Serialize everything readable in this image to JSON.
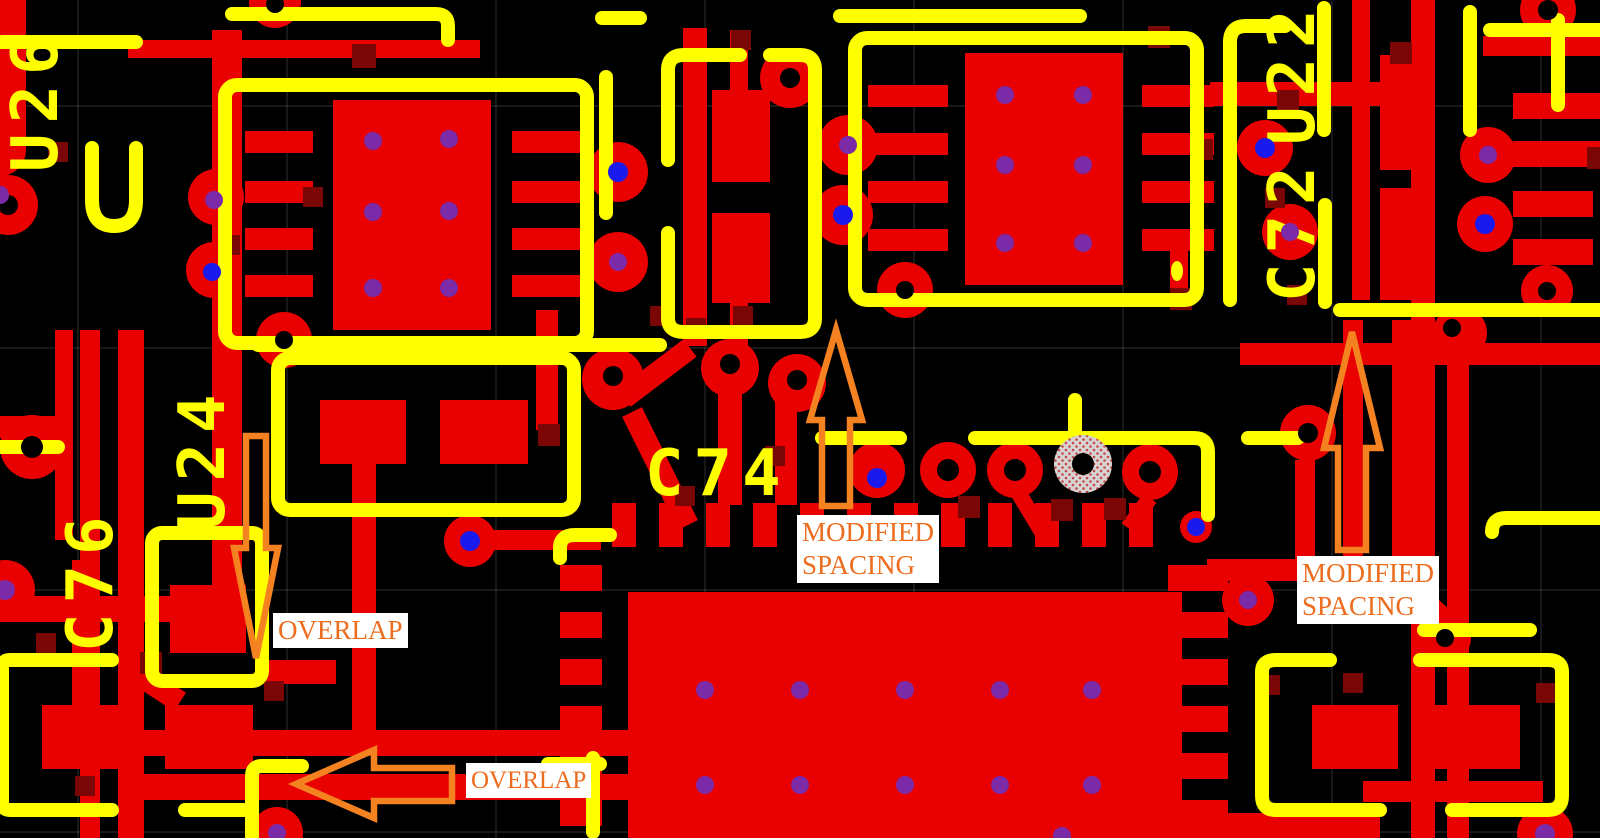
{
  "board": {
    "designators": {
      "u26": "U26",
      "c76": "C76",
      "u24": "U24",
      "c74": "C74",
      "c72": "C72",
      "u22": "U22"
    },
    "annotations": {
      "overlap_top": {
        "text": "OVERLAP"
      },
      "overlap_bottom": {
        "text": "OVERLAP"
      },
      "modified_spacing_center": {
        "line1": "MODIFIED",
        "line2": "SPACING"
      },
      "modified_spacing_right": {
        "line1": "MODIFIED",
        "line2": "SPACING"
      }
    },
    "colors": {
      "background": "#000000",
      "copper": "#E90000",
      "silkscreen": "#FFFF00",
      "via_square": "#7A0606",
      "via_purple": "#7C2BA8",
      "via_blue": "#1A1AEF",
      "annotation_orange": "#ED6C1E",
      "arrow_orange": "#F58220",
      "label_background": "#FFFFFF",
      "unconnected_pad_gray": "#D8D3D3"
    }
  }
}
